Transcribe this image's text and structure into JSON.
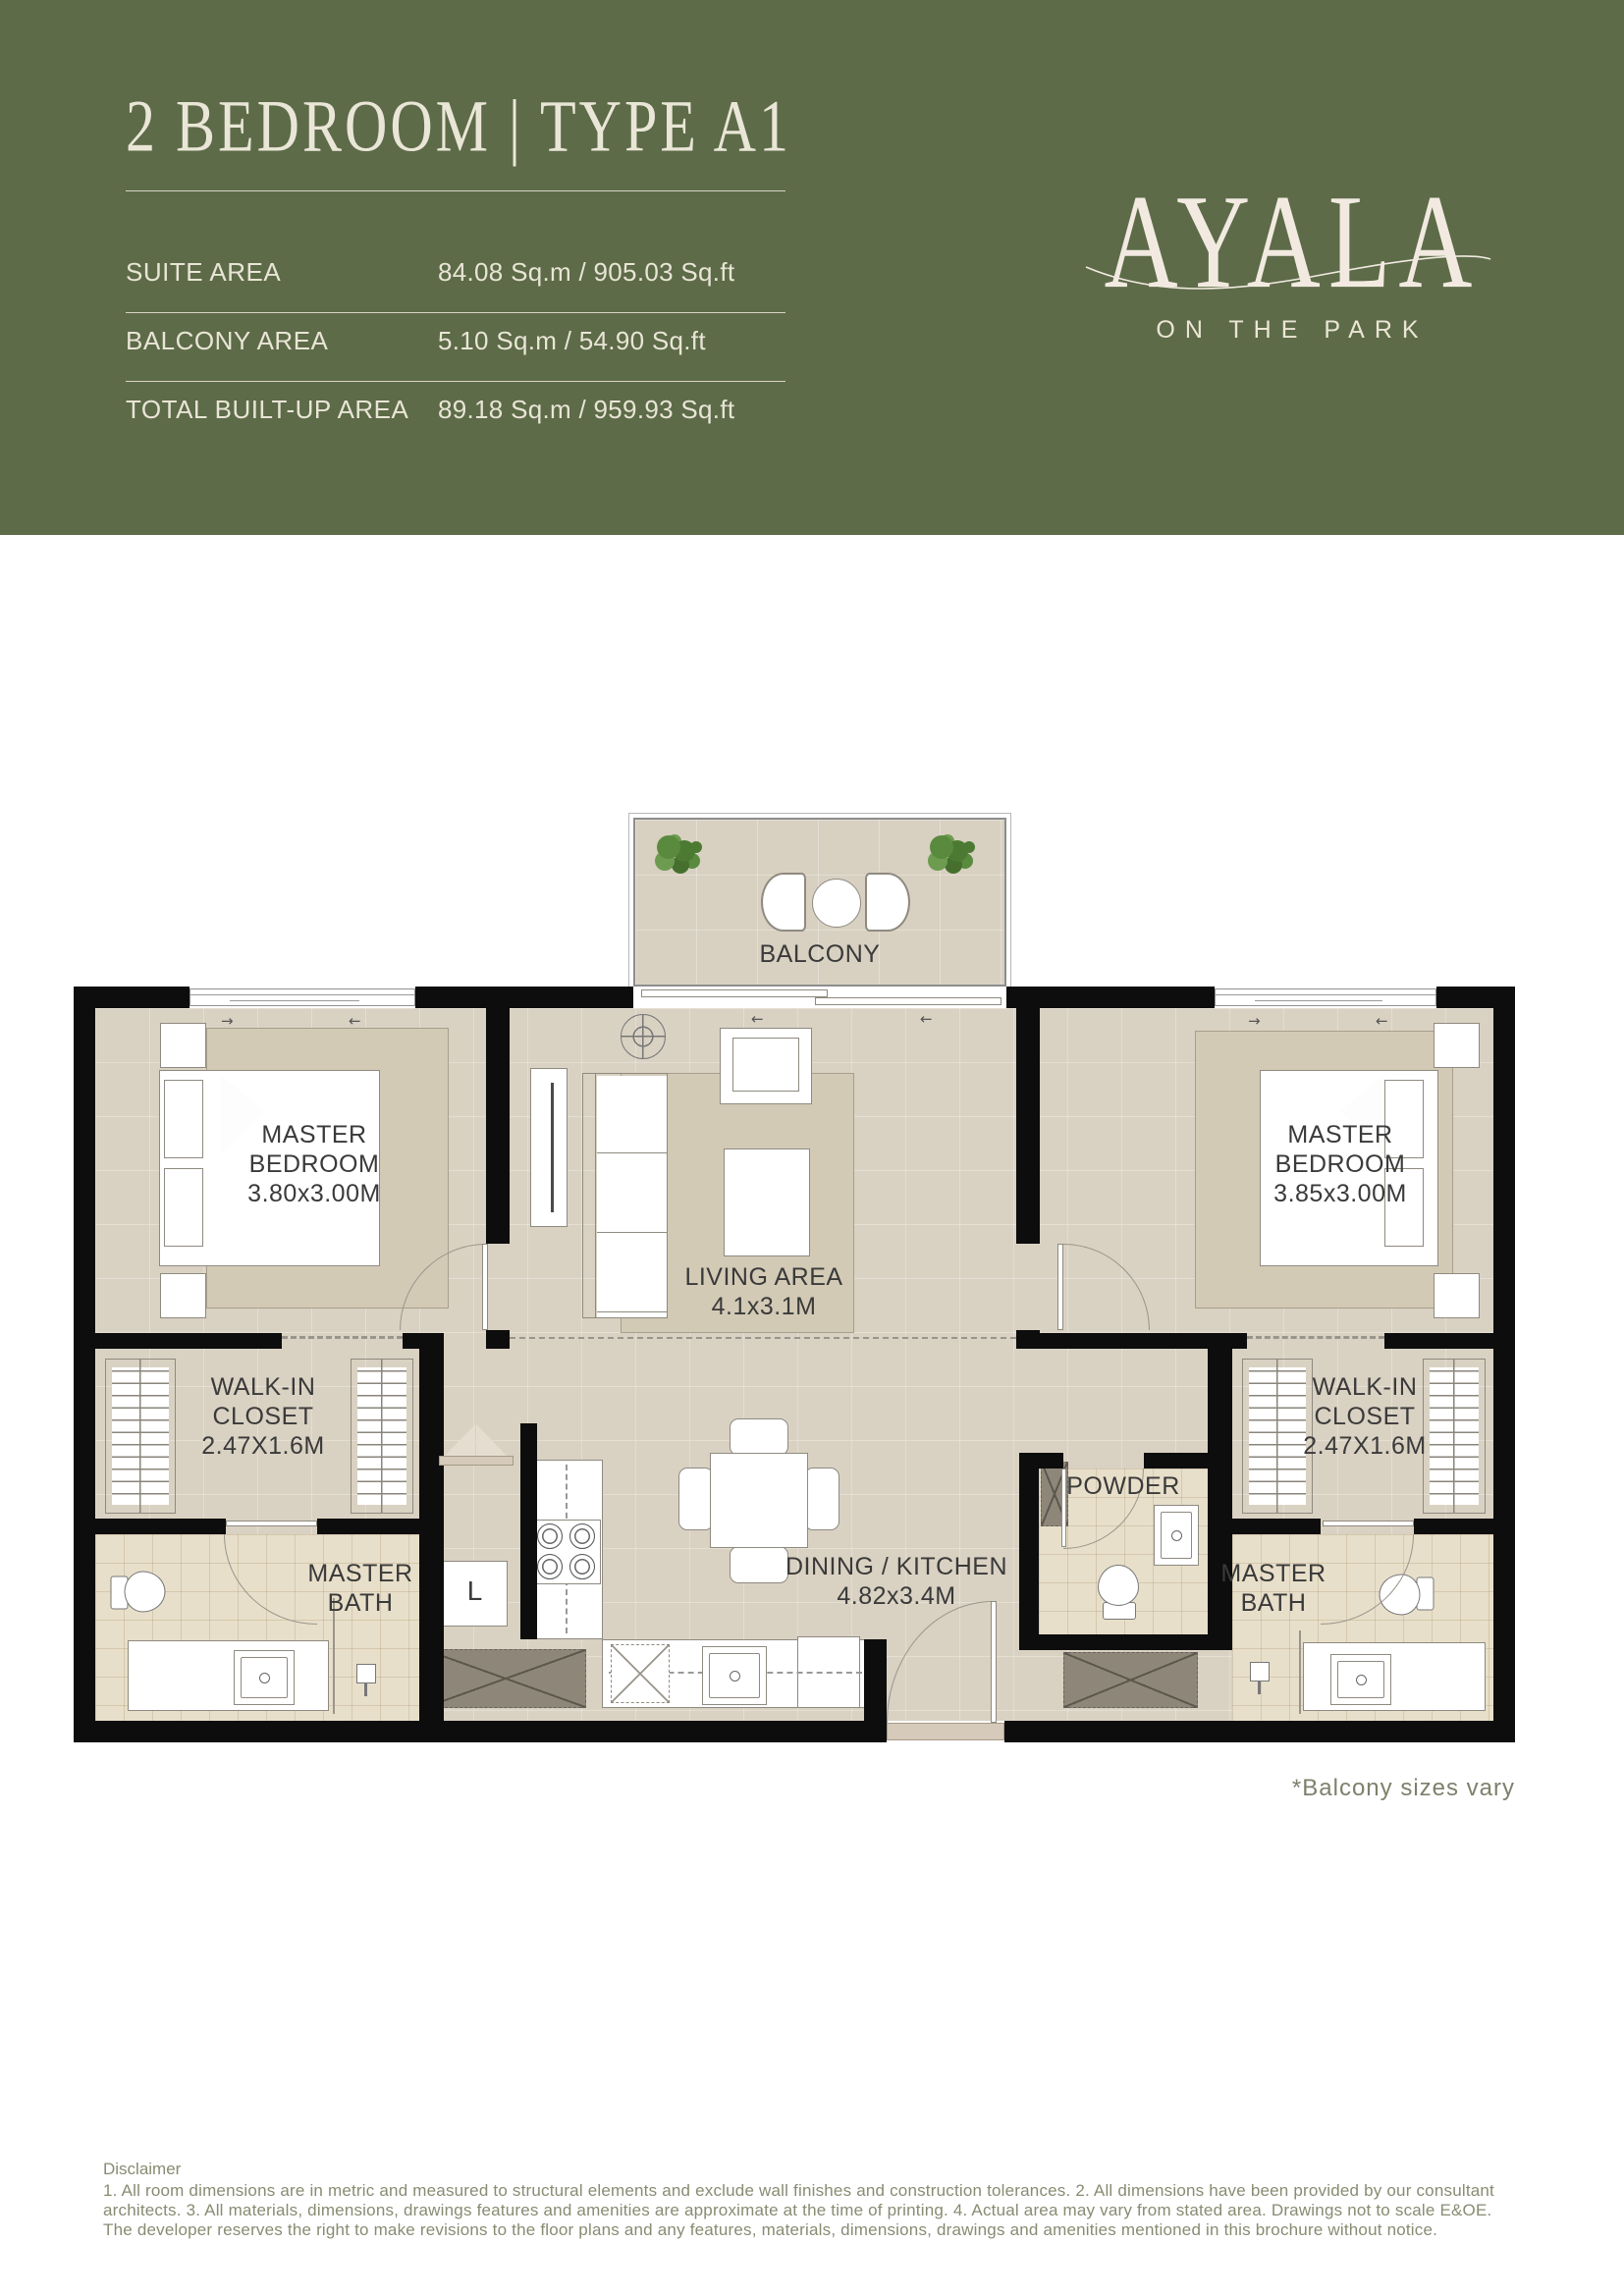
{
  "header": {
    "title": "2 BEDROOM | TYPE A1",
    "specs": [
      {
        "label": "SUITE AREA",
        "value": "84.08 Sq.m / 905.03 Sq.ft"
      },
      {
        "label": "BALCONY AREA",
        "value": "5.10 Sq.m / 54.90 Sq.ft"
      },
      {
        "label": "TOTAL BUILT-UP AREA",
        "value": "89.18 Sq.m / 959.93 Sq.ft"
      }
    ],
    "brand": {
      "name": "AYALA",
      "tagline": "ON THE PARK"
    }
  },
  "floorplan": {
    "note": "*Balcony sizes vary",
    "rooms": {
      "balcony": {
        "label": "BALCONY"
      },
      "bedroom_left": {
        "label": "MASTER BEDROOM",
        "dims": "3.80x3.00M"
      },
      "bedroom_right": {
        "label": "MASTER BEDROOM",
        "dims": "3.85x3.00M"
      },
      "living": {
        "label": "LIVING AREA",
        "dims": "4.1x3.1M"
      },
      "dining_kitchen": {
        "label": "DINING / KITCHEN",
        "dims": "4.82x3.4M"
      },
      "closet_left": {
        "label": "WALK-IN CLOSET",
        "dims": "2.47X1.6M"
      },
      "closet_right": {
        "label": "WALK-IN CLOSET",
        "dims": "2.47X1.6M"
      },
      "bath_left": {
        "label": "MASTER BATH"
      },
      "bath_right": {
        "label": "MASTER BATH"
      },
      "powder": {
        "label": "POWDER"
      },
      "laundry": {
        "label": "L"
      }
    }
  },
  "footer": {
    "disclaimer_title": "Disclaimer",
    "disclaimer_body": "1. All room dimensions are in metric and measured to structural elements and exclude wall finishes and construction tolerances. 2. All dimensions have been provided by our consultant architects. 3. All materials, dimensions, drawings features and amenities are approximate at the time of printing. 4. Actual area may vary from stated area. Drawings not to scale E&OE. The developer reserves the right to make revisions to the floor plans and any features, materials, dimensions, drawings and amenities mentioned in this brochure without notice."
  },
  "colors": {
    "header_bg": "#5d6b48",
    "header_text": "#e9e5d6",
    "brand_text": "#f2eae1",
    "floor": "#d9d1c2",
    "bath_floor": "#e8dfca",
    "wall": "#0d0d0d",
    "note_text": "#7c816b",
    "disclaimer_text": "#878c72"
  }
}
